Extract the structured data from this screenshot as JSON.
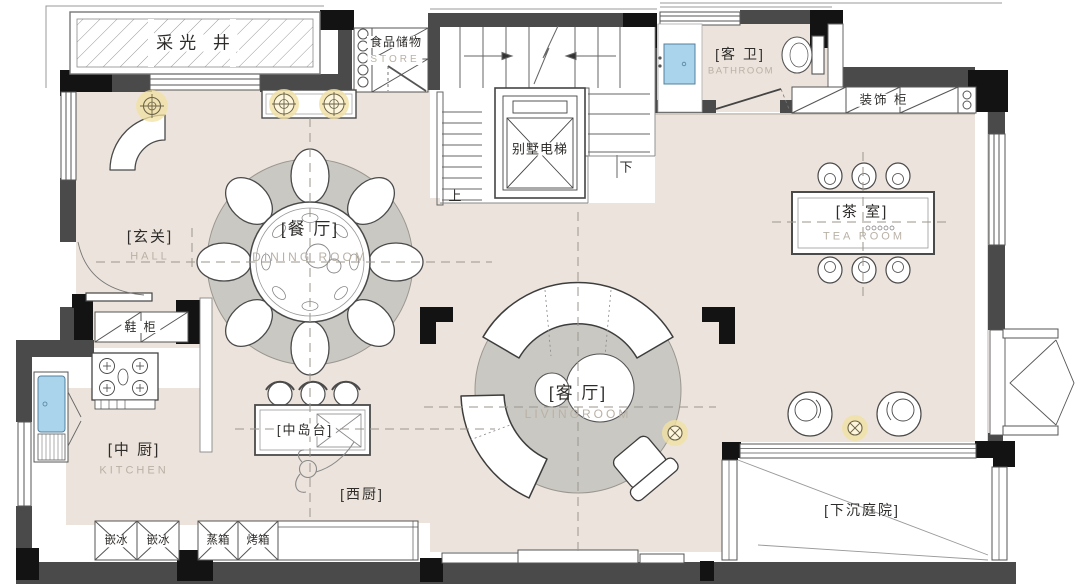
{
  "rooms": {
    "light_well": {
      "cn": "采光 井"
    },
    "pantry": {
      "cn": "食品储物",
      "en": "STORE"
    },
    "elevator": {
      "cn": "别墅电梯"
    },
    "stairs": {
      "up": "上",
      "down": "下"
    },
    "bathroom": {
      "cn": "[客 卫]",
      "en": "BATHROOM"
    },
    "deco_cabinet": {
      "cn": "装饰 柜"
    },
    "tea_room": {
      "cn": "[茶 室]",
      "en": "TEA ROOM"
    },
    "dining": {
      "cn": "[餐 厅]",
      "en": "DINING ROOM"
    },
    "hall": {
      "cn": "[玄关]",
      "en": "HALL"
    },
    "shoe_cabinet": {
      "cn": "鞋 柜"
    },
    "kitchen": {
      "cn": "[中 厨]",
      "en": "KITCHEN"
    },
    "island": {
      "cn": "[中岛台]"
    },
    "west_kitchen": {
      "cn": "[西厨]"
    },
    "living": {
      "cn": "[客 厅]",
      "en": "LIVINGROOM"
    },
    "courtyard": {
      "cn": "[下沉庭院]"
    }
  },
  "appliances": [
    "嵌冰",
    "嵌冰",
    "蒸箱",
    "烤箱"
  ],
  "colors": {
    "floor": "#ece4dc",
    "rug": "#cac8c2",
    "wall_dark": "#4a4a4a",
    "wall_black": "#131313",
    "sink_blue": "#a9d4ec",
    "light_glow": "#f1e1a2",
    "en_label": "#b9b1a5"
  }
}
